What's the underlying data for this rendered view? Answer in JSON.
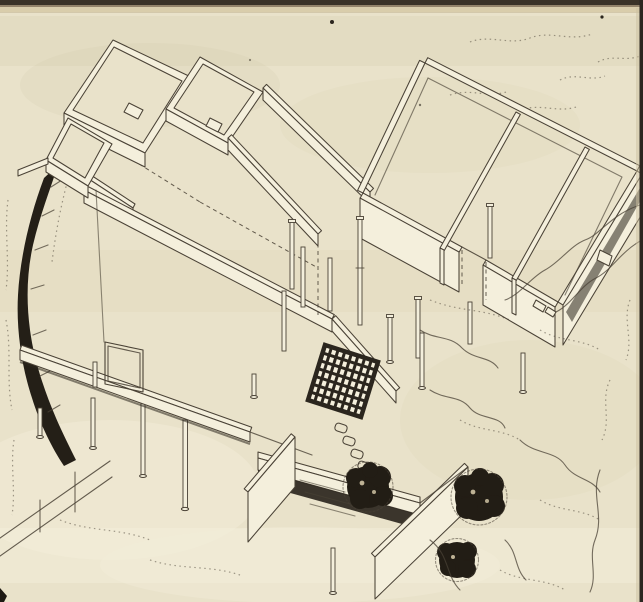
{
  "artwork": {
    "kind": "scanned-book-page",
    "subject": "axonometric-architectural-line-drawing",
    "visible_text": [],
    "elements": {
      "room_clusters": 2,
      "deck_columns": 12,
      "under_slab_columns": 5,
      "trees": 3,
      "trellis_grid": 1,
      "stepping_stones": 4,
      "stream_bands": 1
    }
  },
  "colors": {
    "paper": "#e9e2ca",
    "paper_light": "#f4efdc",
    "paper_shade": "#d8cdae",
    "ink": "#4a4236",
    "ink_dark": "#2b261e",
    "tree": "#221d15",
    "stream": "#241f17",
    "frame_dark": "#3a3227",
    "frame_tan": "#d9cdab",
    "frame_mid": "#93836a",
    "edge_dark": "#2b2620"
  }
}
